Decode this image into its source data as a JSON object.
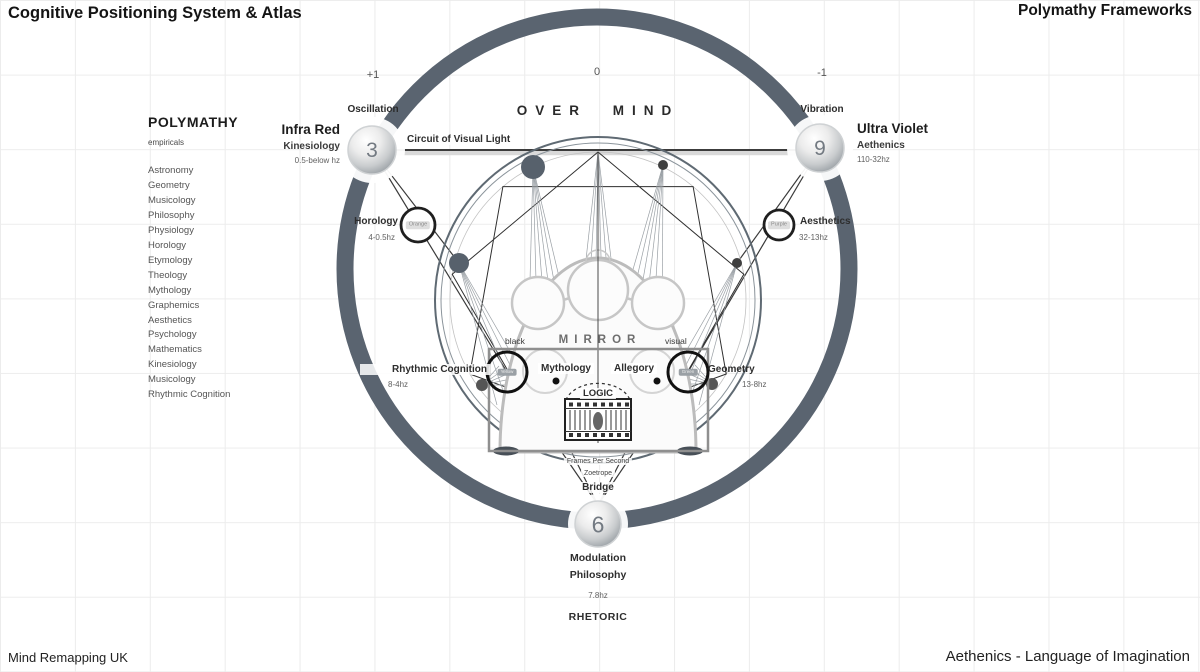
{
  "header": {
    "title_left": "Cognitive Positioning System & Atlas",
    "title_right": "Polymathy Frameworks"
  },
  "footer": {
    "left": "Mind Remapping UK",
    "right": "Aethenics - Language of Imagination"
  },
  "axis": {
    "plus_one": "+1",
    "zero": "0",
    "minus_one": "-1"
  },
  "sidebar": {
    "heading": "POLYMATHY",
    "subheading": "empiricals",
    "items": [
      "Astronomy",
      "Geometry",
      "Musicology",
      "Philosophy",
      "Physiology",
      "Horology",
      "Etymology",
      "Theology",
      "Mythology",
      "Graphemics",
      "Aesthetics",
      "Psychology",
      "Mathematics",
      "Kinesiology",
      "Musicology",
      "Rhythmic Cognition"
    ]
  },
  "nodes": {
    "three": {
      "number": "3",
      "top_label": "Oscillation",
      "name": "Infra Red",
      "field": "Kinesiology",
      "freq": "0.5-below hz"
    },
    "nine": {
      "number": "9",
      "top_label": "Vibration",
      "name": "Ultra Violet",
      "field": "Aethenics",
      "freq": "110-32hz"
    },
    "six": {
      "number": "6",
      "bridge": "Bridge",
      "line1": "Modulation",
      "line2": "Philosophy",
      "freq": "7.8hz",
      "caption": "RHETORIC"
    },
    "orange": {
      "color_label": "Orange",
      "label": "Horology",
      "freq": "4-0.5hz"
    },
    "purple": {
      "color_label": "Purple",
      "label": "Aesthetics",
      "freq": "32-13hz"
    },
    "yellow": {
      "color_label": "Yellow",
      "label": "Rhythmic Cognition",
      "freq": "8-4hz"
    },
    "green": {
      "color_label": "Green",
      "label": "Geometry",
      "freq": "13-8hz"
    }
  },
  "center": {
    "over_mind": "OVER MIND",
    "circuit": "Circuit of Visual Light",
    "mirror": "MIRROR",
    "black": "black",
    "visual": "visual",
    "mythology": "Mythology",
    "allegory": "Allegory",
    "logic": "LOGIC",
    "fps": "Frames Per Second",
    "zoetrope": "Zoetrope"
  },
  "colors": {
    "ring": "#5a6470",
    "dot": "#57616c",
    "grid": "#ececec",
    "metal_edge": "#9aa0a5"
  }
}
